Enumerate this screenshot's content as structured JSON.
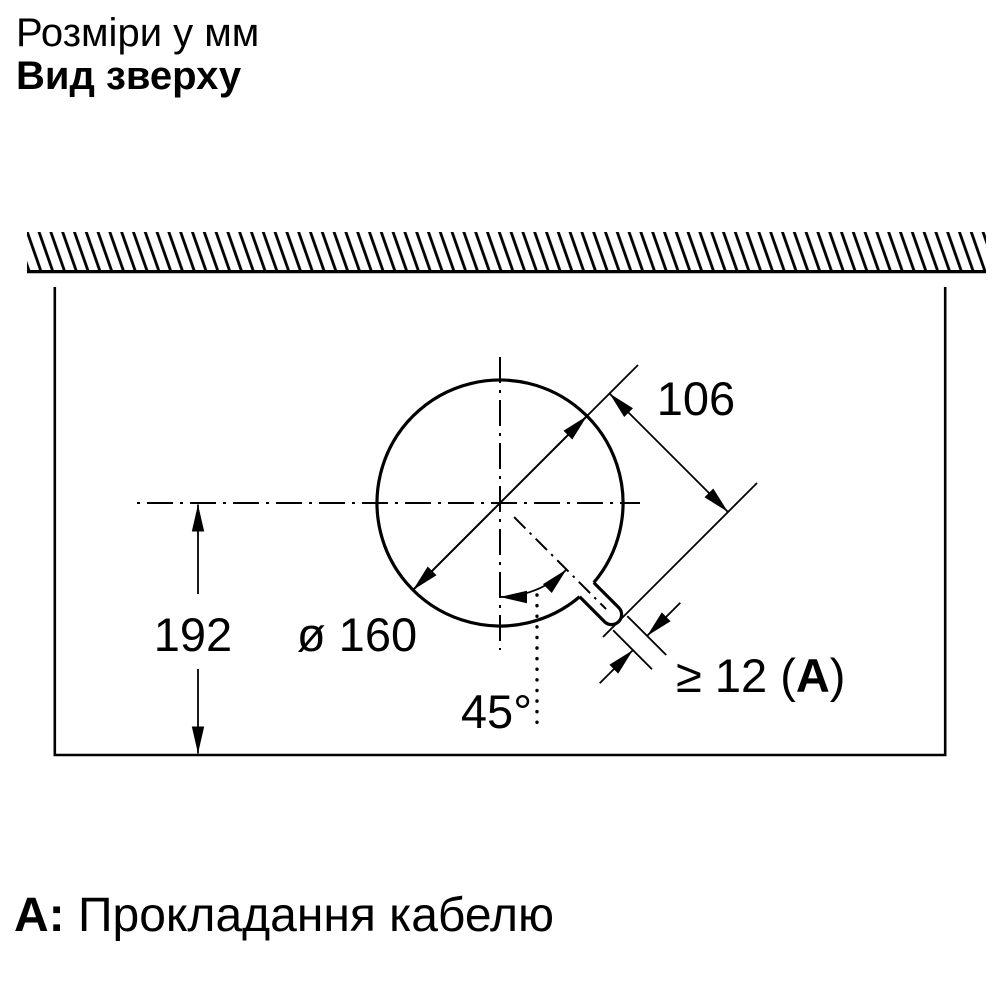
{
  "header": {
    "units_note": "Розміри у мм",
    "view_title": "Вид зверху"
  },
  "dimension_labels": {
    "cutout_diameter": "ø 160",
    "center_to_front_edge": "192",
    "slot_center_distance": "106",
    "slot_width_open": "≥ 12 (",
    "slot_width_ref": "A",
    "slot_width_close": ")",
    "slot_angle": "45°"
  },
  "legend": {
    "key": "A:",
    "description": "Прокладання кабелю"
  },
  "colors": {
    "ink": "#000000",
    "paper": "#ffffff"
  }
}
